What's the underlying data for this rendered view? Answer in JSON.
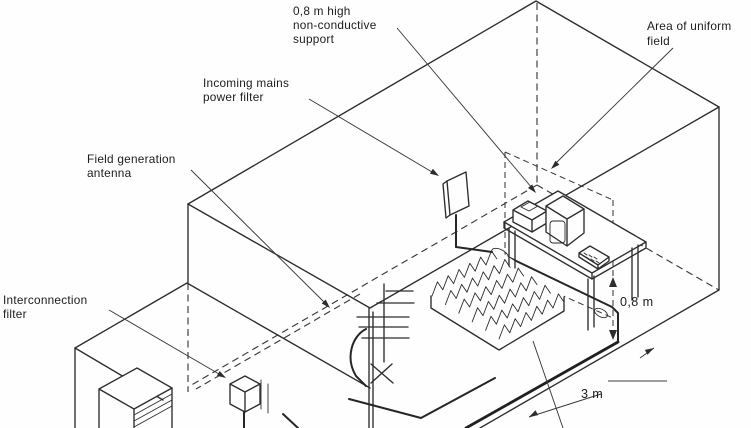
{
  "diagram": {
    "background": "#fefefe",
    "ink": "#2d2d2d",
    "labels": {
      "support": {
        "line1": "0,8 m high",
        "line2": "non-conductive",
        "line3": "support"
      },
      "uniform_field": {
        "line1": "Area of uniform",
        "line2": "field"
      },
      "mains_filter": {
        "line1": "Incoming mains",
        "line2": "power filter"
      },
      "antenna": {
        "line1": "Field generation",
        "line2": "antenna"
      },
      "interconnection": {
        "line1": "Interconnection",
        "line2": "filter"
      }
    },
    "dimensions": {
      "table_height": "0,8 m",
      "antenna_distance": "3 m"
    },
    "absorber": {
      "origin": [
        432,
        296
      ],
      "row_step": [
        13.4,
        8.6
      ],
      "rows": 6,
      "tooth_step": [
        10.8,
        -6.2
      ],
      "teeth": 6,
      "peak": 11
    }
  }
}
